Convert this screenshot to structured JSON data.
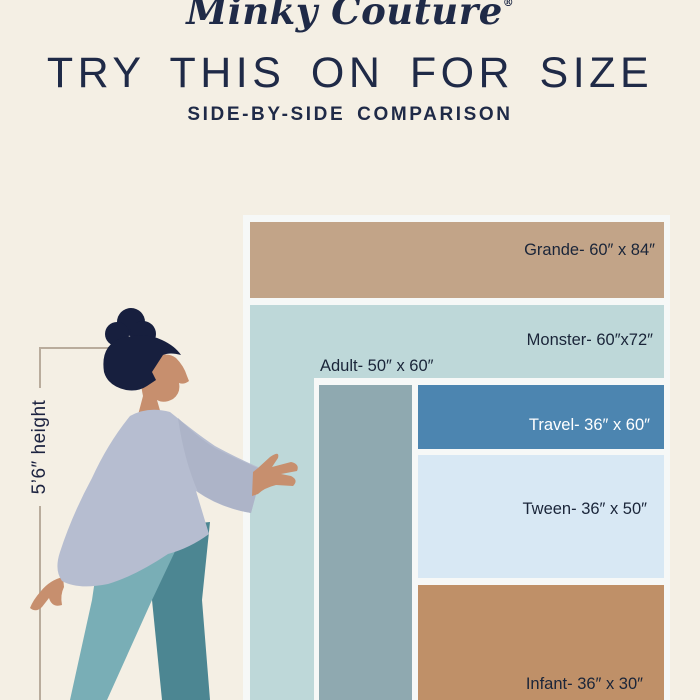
{
  "brand": {
    "logo_text": "Minky Couture",
    "registered_mark": "®"
  },
  "header": {
    "title": "TRY THIS ON FOR SIZE",
    "subtitle": "SIDE-BY-SIDE COMPARISON"
  },
  "reference_person": {
    "height_label": "5’6″ height",
    "height": "5’6″"
  },
  "chart_data": {
    "type": "table",
    "title": "Minky Couture blanket size comparison",
    "reference_height": "5’6″",
    "items": [
      {
        "name": "Grande",
        "label": "Grande- 60″ x 84″",
        "width_in": 60,
        "length_in": 84,
        "color": "#c2a488",
        "text_color": "#1a2539"
      },
      {
        "name": "Monster",
        "label": "Monster- 60″x72″",
        "width_in": 60,
        "length_in": 72,
        "color": "#bed8d9",
        "text_color": "#1a2539"
      },
      {
        "name": "Adult",
        "label": "Adult- 50″ x 60″",
        "width_in": 50,
        "length_in": 60,
        "color": "#8fa9b0",
        "text_color": "#1a2539"
      },
      {
        "name": "Travel",
        "label": "Travel- 36″ x 60″",
        "width_in": 36,
        "length_in": 60,
        "color": "#4c85b0",
        "text_color": "#ffffff"
      },
      {
        "name": "Tween",
        "label": "Tween- 36″ x 50″",
        "width_in": 36,
        "length_in": 50,
        "color": "#d8e8f4",
        "text_color": "#1a2539"
      },
      {
        "name": "Infant",
        "label": "Infant- 36″ x 30″",
        "width_in": 36,
        "length_in": 30,
        "color": "#bf9068",
        "text_color": "#1a2539"
      }
    ]
  },
  "colors": {
    "background": "#f4efe4",
    "frame": "#f6f8f7",
    "heading_text": "#1f2a47",
    "label_text": "#1a2539",
    "bracket_line": "#b9ac9c",
    "person_hair": "#171f3e",
    "person_skin": "#c78f6e",
    "person_sweater": "#b6bdd0",
    "person_pants_front": "#79aeb6",
    "person_pants_back": "#4c8692"
  }
}
